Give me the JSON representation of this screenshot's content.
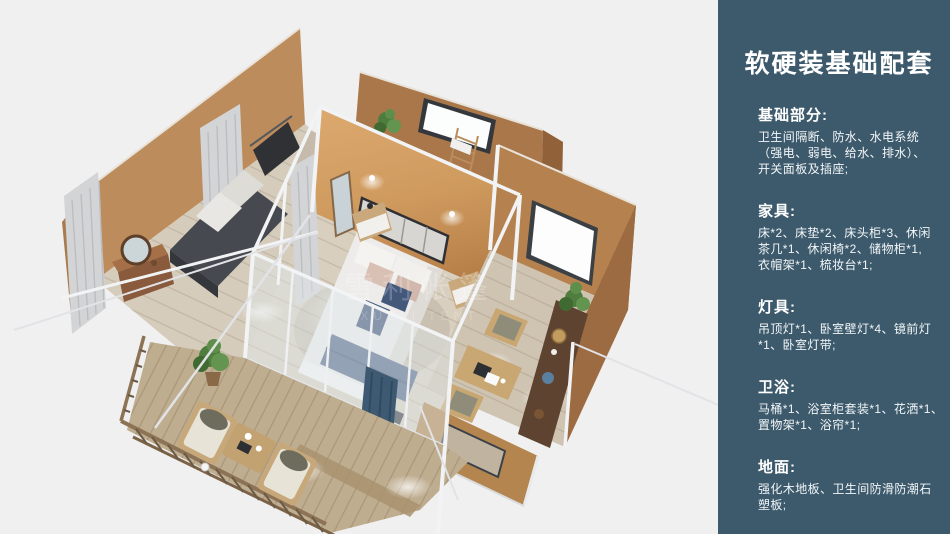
{
  "page": {
    "background": "#f0f0f1"
  },
  "sidebar": {
    "background": "#3d5a6c",
    "text_color": "#f2f6f8",
    "title": "软硬装基础配套",
    "sections": [
      {
        "title": "基础部分:",
        "lines": [
          "卫生间隔断、防水、水电系统",
          "（强电、弱电、给水、排水）、",
          "开关面板及插座;"
        ]
      },
      {
        "title": "家具:",
        "lines": [
          "床*2、床垫*2、床头柜*3、休闲",
          "茶几*1、休闲椅*2、储物柜*1,",
          "衣帽架*1、梳妆台*1;"
        ]
      },
      {
        "title": "灯具:",
        "lines": [
          "吊顶灯*1、卧室壁灯*4、镜前灯",
          "*1、卧室灯带;"
        ]
      },
      {
        "title": "卫浴:",
        "lines": [
          "马桶*1、浴室柜套装*1、花洒*1、",
          "置物架*1、浴帘*1;"
        ]
      },
      {
        "title": "地面:",
        "lines": [
          "强化木地板、卫生间防滑防潮石",
          "塑板;"
        ]
      }
    ]
  },
  "render": {
    "watermark_cn": "雪利帐篷",
    "watermark_en": "XUELI TENT",
    "palette": {
      "wall_tan": "#b5824f",
      "wall_lit": "#d09a62",
      "floor_wood": "#d6ccbc",
      "deck_wood": "#bfad90",
      "frame_white": "#f2f3f5",
      "bedding_blue": "#56688a",
      "sofa_gray": "#46494f",
      "plant_green": "#5d8f4a",
      "cabinet_brown": "#5e4430",
      "curtain_gray": "#d3d4d6"
    }
  }
}
